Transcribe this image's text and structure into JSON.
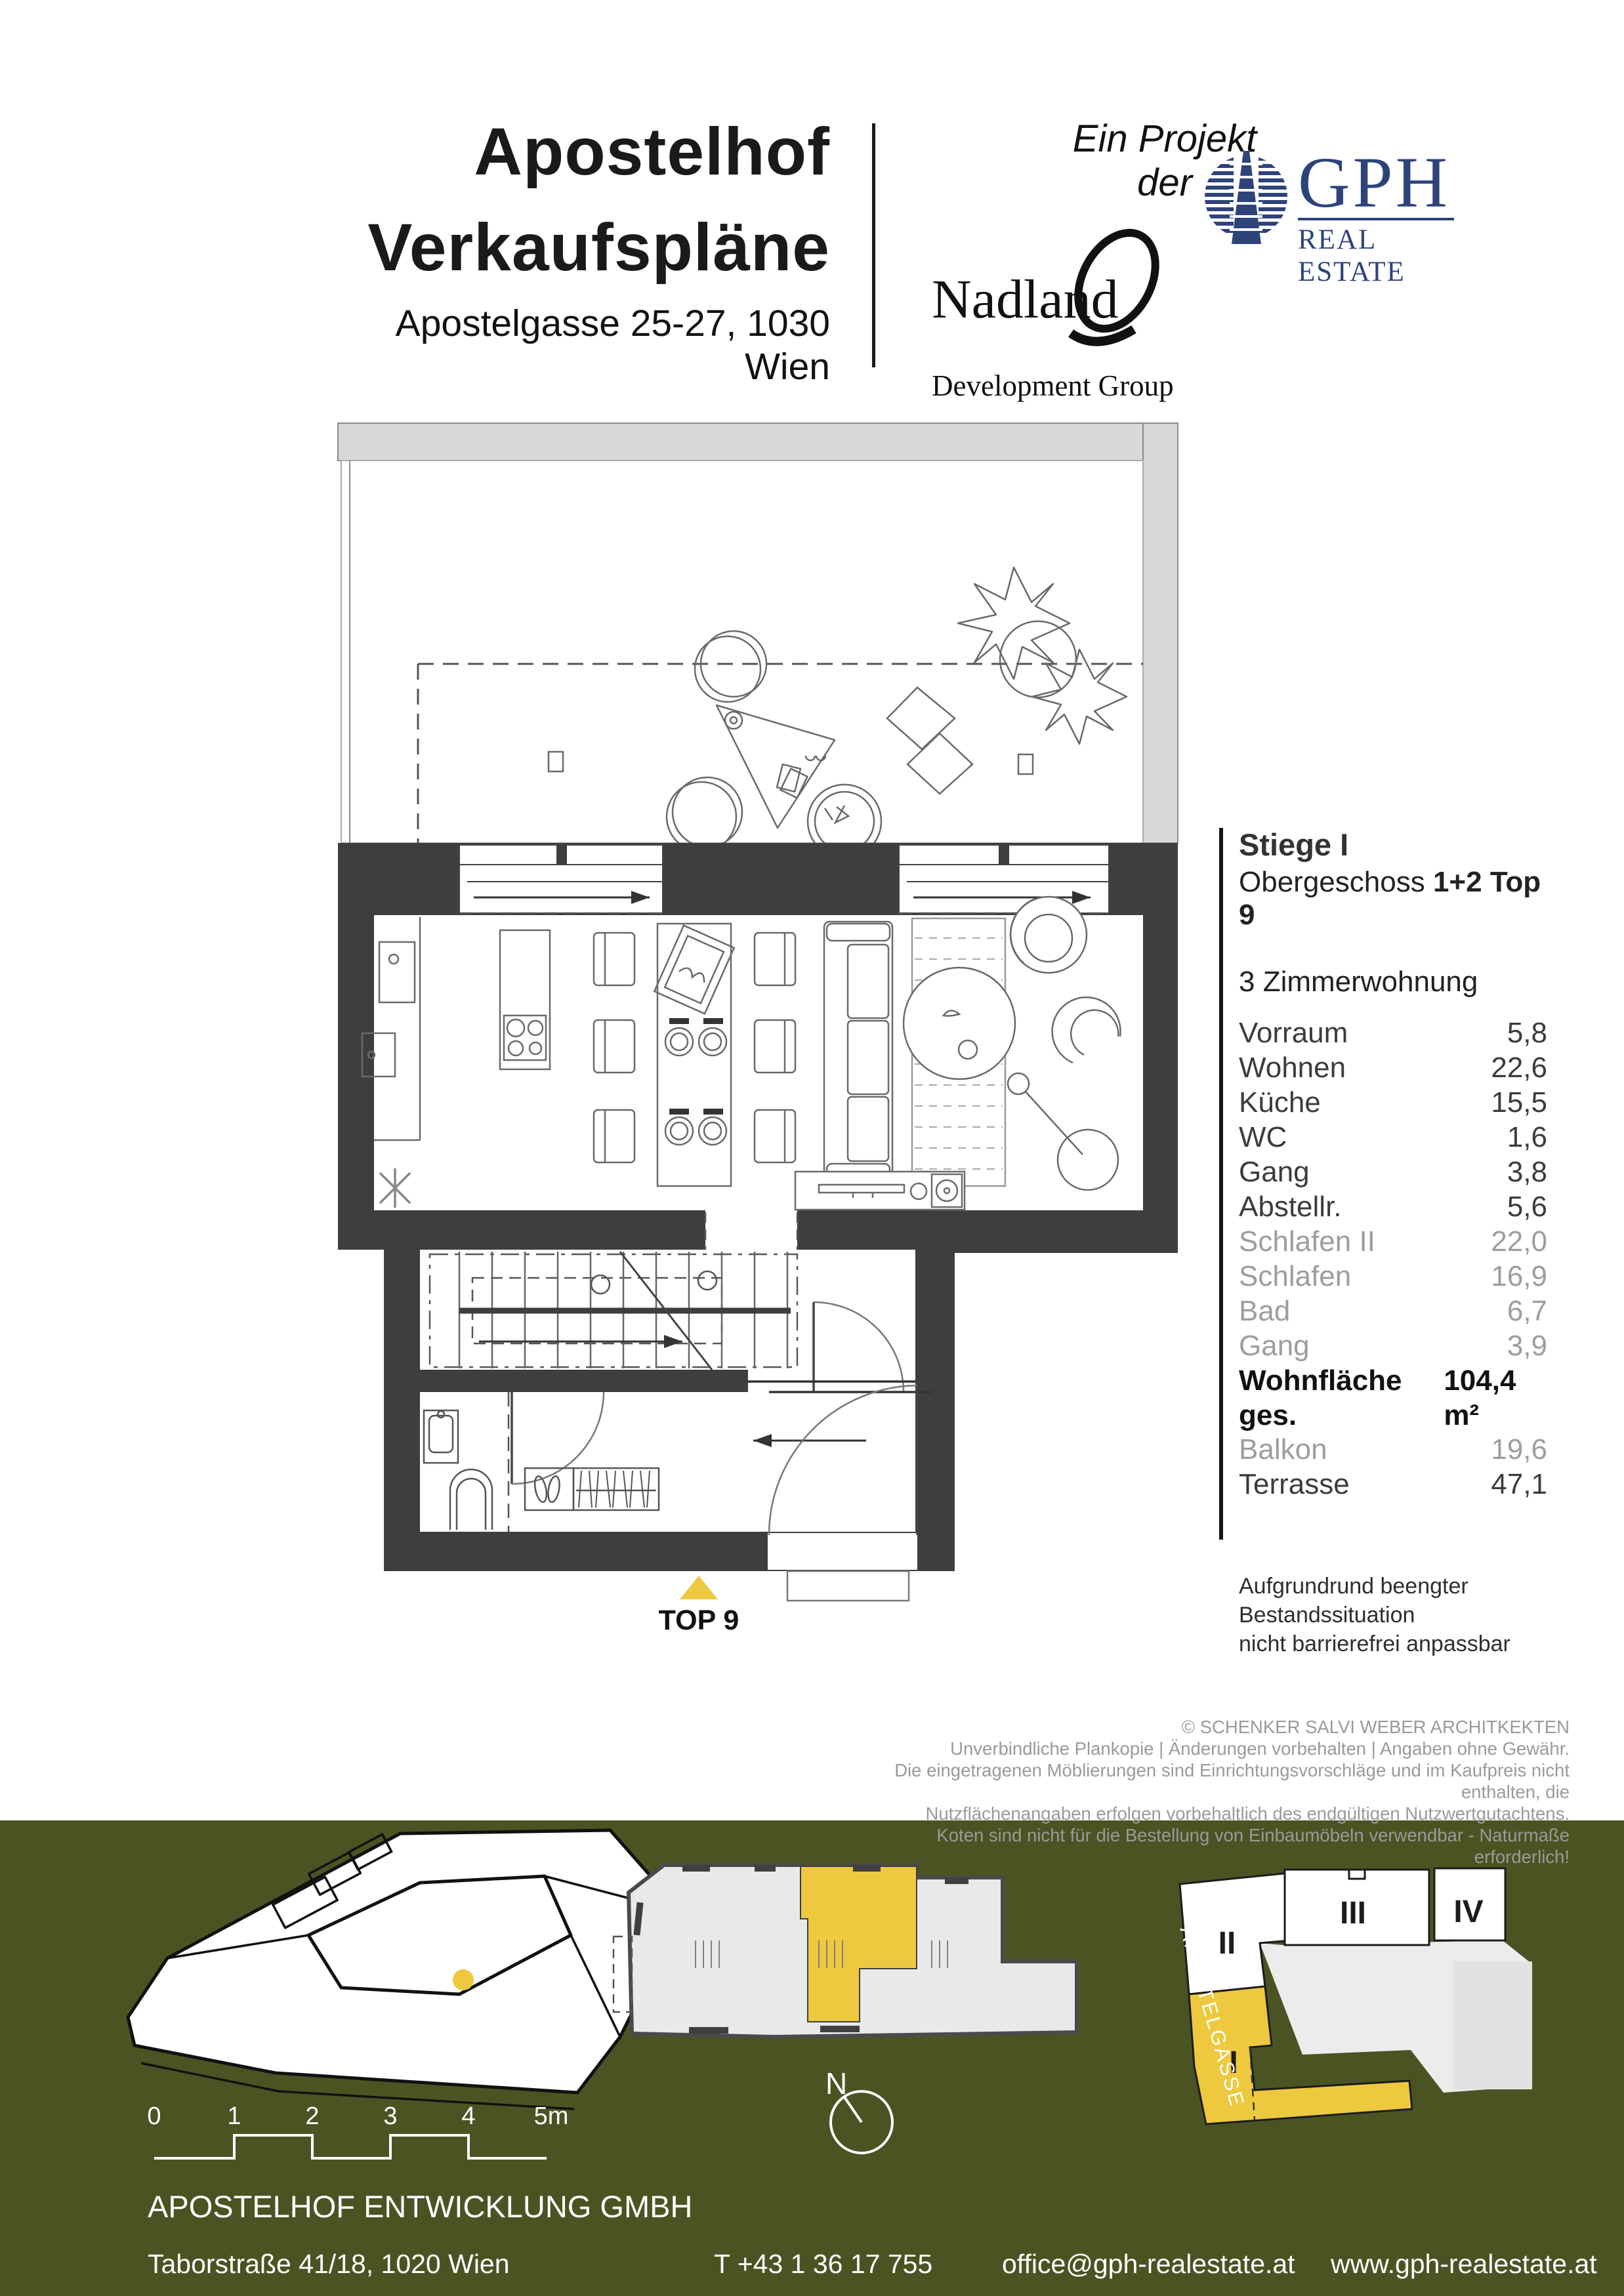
{
  "colors": {
    "accent_yellow": "#eec93f",
    "gph_blue": "#2d4379",
    "band_green": "#4a5423",
    "wall_dark": "#3e3e3e",
    "terrace_gray": "#d8d8d8"
  },
  "header": {
    "title_line1": "Apostelhof",
    "title_line2": "Verkaufspläne",
    "address": "Apostelgasse 25-27, 1030 Wien",
    "project_note": "Ein Projekt der",
    "nadland_name": "Nadland",
    "nadland_sub": "Development Group",
    "gph_name": "GPH",
    "gph_sub": "REAL ESTATE"
  },
  "unit_info": {
    "stiege": "Stiege I",
    "floor_prefix": "Obergeschoss",
    "floor_bold": "1+2",
    "top_label": "Top 9",
    "type": "3 Zimmerwohnung",
    "rooms": [
      {
        "label": "Vorraum",
        "value": "5,8"
      },
      {
        "label": "Wohnen",
        "value": "22,6"
      },
      {
        "label": "Küche",
        "value": "15,5"
      },
      {
        "label": "WC",
        "value": "1,6"
      },
      {
        "label": "Gang",
        "value": "3,8"
      },
      {
        "label": "Abstellr.",
        "value": "5,6"
      },
      {
        "label": "Schlafen II",
        "value": "22,0"
      },
      {
        "label": "Schlafen",
        "value": "16,9"
      },
      {
        "label": "Bad",
        "value": "6,7"
      },
      {
        "label": "Gang",
        "value": "3,9"
      }
    ],
    "total_label": "Wohnfläche ges.",
    "total_value": "104,4 m²",
    "outdoor": [
      {
        "label": "Balkon",
        "value": "19,6"
      },
      {
        "label": "Terrasse",
        "value": "47,1"
      }
    ],
    "note_line1": "Aufgrundrund beengter Bestandssituation",
    "note_line2": "nicht barrierefrei anpassbar"
  },
  "plan": {
    "unit_label": "TOP 9"
  },
  "disclaimer": {
    "line1": "© SCHENKER SALVI WEBER ARCHITKEKTEN",
    "line2": "Unverbindliche Plankopie | Änderungen vorbehalten | Angaben ohne Gewähr.",
    "line3": "Die eingetragenen Möblierungen sind Einrichtungsvorschläge und im Kaufpreis nicht enthalten, die",
    "line4": "Nutzflächenangaben erfolgen vorbehaltlich des endgültigen Nutzwertgutachtens.",
    "line5": "Koten sind nicht für die Bestellung von Einbaumöbeln verwendbar - Naturmaße erforderlich!"
  },
  "map": {
    "street": "APOSTELGASSE",
    "block_i": "I",
    "block_ii": "II",
    "block_iii": "III",
    "block_iv": "IV",
    "north": "N"
  },
  "scalebar": {
    "l0": "0",
    "l1": "1",
    "l2": "2",
    "l3": "3",
    "l4": "4",
    "l5": "5m"
  },
  "footer": {
    "company": "APOSTELHOF ENTWICKLUNG GMBH",
    "address": "Taborstraße 41/18, 1020 Wien",
    "phone": "T +43 1 36 17 755",
    "email": "office@gph-realestate.at",
    "website": "www.gph-realestate.at"
  }
}
